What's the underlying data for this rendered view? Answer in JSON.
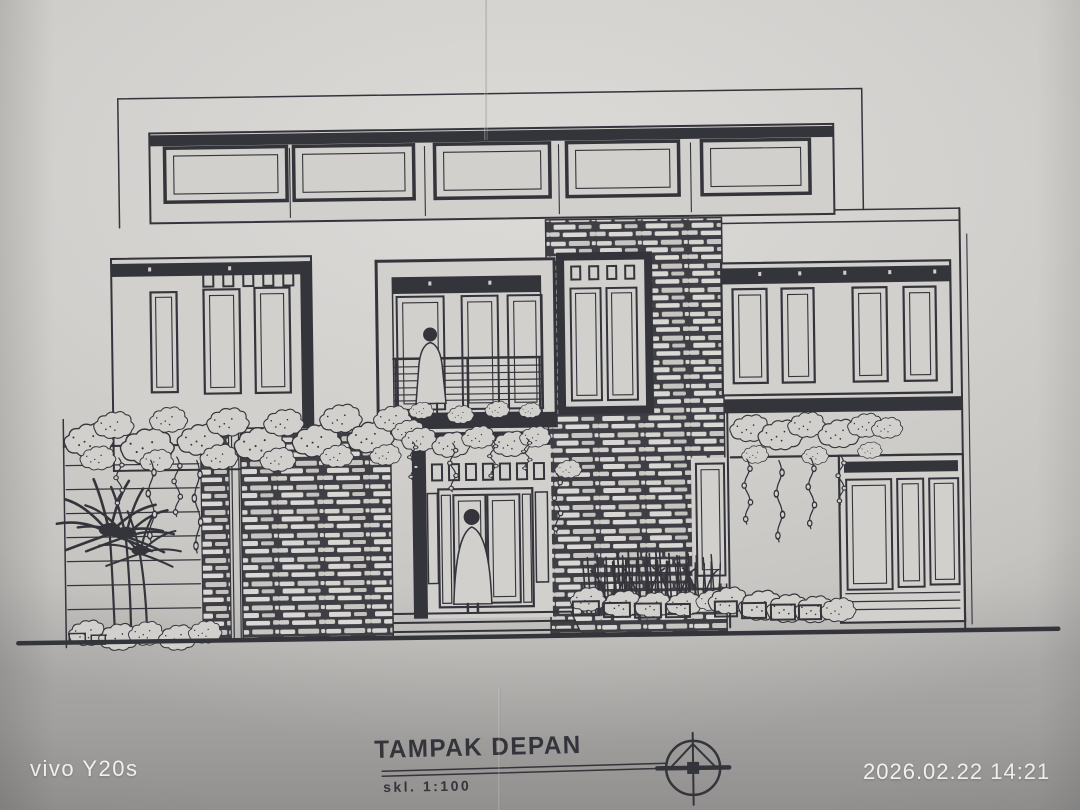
{
  "photo": {
    "device_watermark": "vivo Y20s",
    "timestamp": "2026.02.22 14:21"
  },
  "drawing": {
    "title": "TAMPAK DEPAN",
    "scale_label": "skl. 1:100"
  },
  "icons": {
    "north_arrow": "circle-with-inscribed-triangle-and-crosshair"
  },
  "colors": {
    "paper": "#d2d0cd",
    "ink": "#34343b",
    "stone_dark": "#3e3e44",
    "watermark_text": "#f2f1ee",
    "paper_shadow": "#a8a6a4"
  }
}
